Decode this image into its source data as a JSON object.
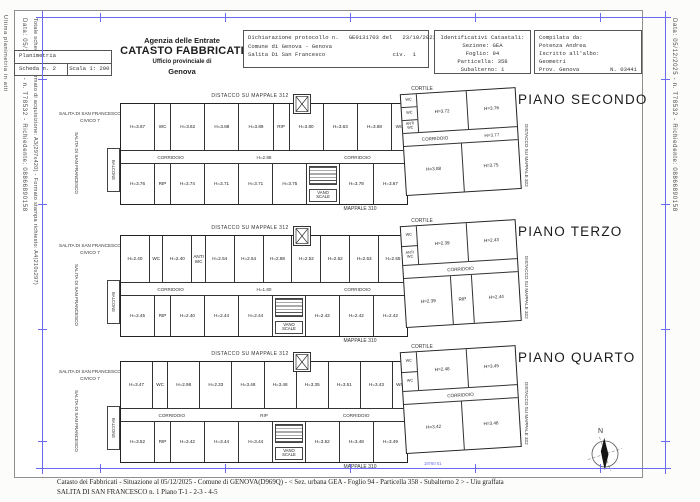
{
  "margins": {
    "left_outer": "Ultima planimetria in atti",
    "left_line1": "Data: 05/12/2025 - n. T78532 - Richiedente: 08866890158",
    "left_line2": "Totale schede: 4 - Formato di acquisizione: A3(297x420) - Formato stampa richiesto: A4(210x297)",
    "right_line": "Data: 05/12/2025 - n. T78532 - Richiedente: 08866890158",
    "stamp": "18760 01"
  },
  "header": {
    "scala_box": {
      "row1": "Planimetria",
      "scheda": "Scheda n. 2",
      "scala": "Scala 1: 200"
    },
    "agency": {
      "line1": "Agenzia delle Entrate",
      "line2": "CATASTO FABBRICATI",
      "line3": "Ufficio provinciale di",
      "line4": "Genova"
    },
    "declaration": {
      "line1": "Dichiarazione protocollo n.   GE0131703 del   23/10/2023",
      "line2": "Comune di Genova - Genova",
      "line3": "Salita Di San Francesco",
      "civ": "civ.  1"
    },
    "cadastral": {
      "title": "Identificativi Catastali:",
      "sezione": "Sezione: GEA",
      "foglio": "Foglio: 94",
      "particella": "Particella: 358",
      "subalterno": "Subalterno: 1"
    },
    "compiler": {
      "title": "Compilata da:",
      "name": "Potenza Andrea",
      "albo": "Iscritto all'albo:",
      "profession": "Geometri",
      "prov": "Prov. Genova",
      "num": "N. 03441"
    }
  },
  "plans": [
    {
      "title": "PIANO SECONDO",
      "top_label": "DISTACCO SU MAPPALE 312",
      "cortile": "CORTILE",
      "mappale": "MAPPALE 310",
      "right_label": "DISTACCO SU MAPPALE 322",
      "street1": "SALITA DI SAN FRANCESCO",
      "street2": "CIVICO 7",
      "street_vertical": "SALITA DI SAN FRANCESCO",
      "balcone": "BALCONE",
      "rooms_top": [
        "H=3.67",
        "WC",
        "H=3.62",
        "H=3.88",
        "H=3.89",
        "RIP",
        "H=3.80",
        "H=3.63",
        "H=3.88",
        "WC"
      ],
      "corridor": [
        "CORRIDOIO",
        "H=2.88",
        "CORRIDOIO"
      ],
      "rooms_bottom": [
        "H=3.76",
        "RIP",
        "H=3.74",
        "H=3.71",
        "H=3.71",
        "H=3.75",
        "VANO SCALE",
        "H=3.78",
        "H=3.67"
      ],
      "wing_side": [
        "WC",
        "WC",
        "ANTI WC"
      ],
      "wing_top": [
        "H=3.72",
        "H=3.76"
      ],
      "wing_corridor": [
        "CORRIDOIO",
        "H=3.77"
      ],
      "wing_bottom": [
        "H=3.88",
        "H=3.75"
      ]
    },
    {
      "title": "PIANO TERZO",
      "top_label": "DISTACCO SU MAPPALE 312",
      "cortile": "CORTILE",
      "mappale": "MAPPALE 310",
      "right_label": "DISTACCO SU MAPPALE 322",
      "street1": "SALITA DI SAN FRANCESCO",
      "street2": "CIVICO 7",
      "street_vertical": "SALITA DI SAN FRANCESCO",
      "balcone": "BALCONE",
      "rooms_top": [
        "H=2.40",
        "WC",
        "H=2.40",
        "ANTI WC",
        "H=2.54",
        "H=2.54",
        "H=2.88",
        "H=2.52",
        "H=2.62",
        "H=2.53",
        "H=2.55"
      ],
      "corridor": [
        "CORRIDOIO",
        "H=1.80",
        "CORRIDOIO"
      ],
      "rooms_bottom": [
        "H=2.45",
        "RIP",
        "H=2.40",
        "H=2.44",
        "H=2.44",
        "VANO SCALE",
        "H=2.43",
        "H=2.42",
        "H=2.42"
      ],
      "wing_side": [
        "WC",
        "ANTI WC"
      ],
      "wing_top": [
        "H=2.39",
        "H=2.43"
      ],
      "wing_corridor": [
        "CORRIDOIO"
      ],
      "wing_bottom": [
        "H=2.39",
        "RIP",
        "H=2.44"
      ]
    },
    {
      "title": "PIANO QUARTO",
      "top_label": "DISTACCO SU MAPPALE 312",
      "cortile": "CORTILE",
      "mappale": "MAPPALE 310",
      "right_label": "DISTACCO SU MAPPALE 322",
      "street1": "SALITA DI SAN FRANCESCO",
      "street2": "CIVICO 7",
      "street_vertical": "SALITA DI SAN FRANCESCO",
      "balcone": "BALCONE",
      "rooms_top": [
        "H=3.47",
        "WC",
        "H=2.98",
        "H=2.33",
        "H=3.48",
        "H=3.48",
        "H=3.35",
        "H=3.51",
        "H=3.43",
        "WC"
      ],
      "corridor": [
        "CORRIDOIO",
        "RIP",
        "CORRIDOIO"
      ],
      "rooms_bottom": [
        "H=3.52",
        "RIP",
        "H=3.42",
        "H=3.44",
        "H=3.44",
        "VANO SCALE",
        "H=3.52",
        "H=3.48",
        "H=3.49"
      ],
      "wing_side": [
        "WC",
        "WC"
      ],
      "wing_top": [
        "H=2.48",
        "H=3.45"
      ],
      "wing_corridor": [
        "CORRIDOIO"
      ],
      "wing_bottom": [
        "H=3.42",
        "H=3.48"
      ]
    }
  ],
  "compass": {
    "north": "N"
  },
  "footer": {
    "line1": "Catasto dei Fabbricati - Situazione al 05/12/2025 - Comune di GENOVA(D969Q) - < Sez. urbana GEA -  Foglio 94 - Particella  358 - Subalterno 2 > - Uiu graffata",
    "line2": "SALITA DI SAN FRANCESCO n. 1 Piano T-1 - 2-3 - 4-5"
  },
  "colors": {
    "frame_blue": "#6a6af0",
    "line_gray": "#8f8f8f",
    "ink": "#2a2a2a"
  }
}
